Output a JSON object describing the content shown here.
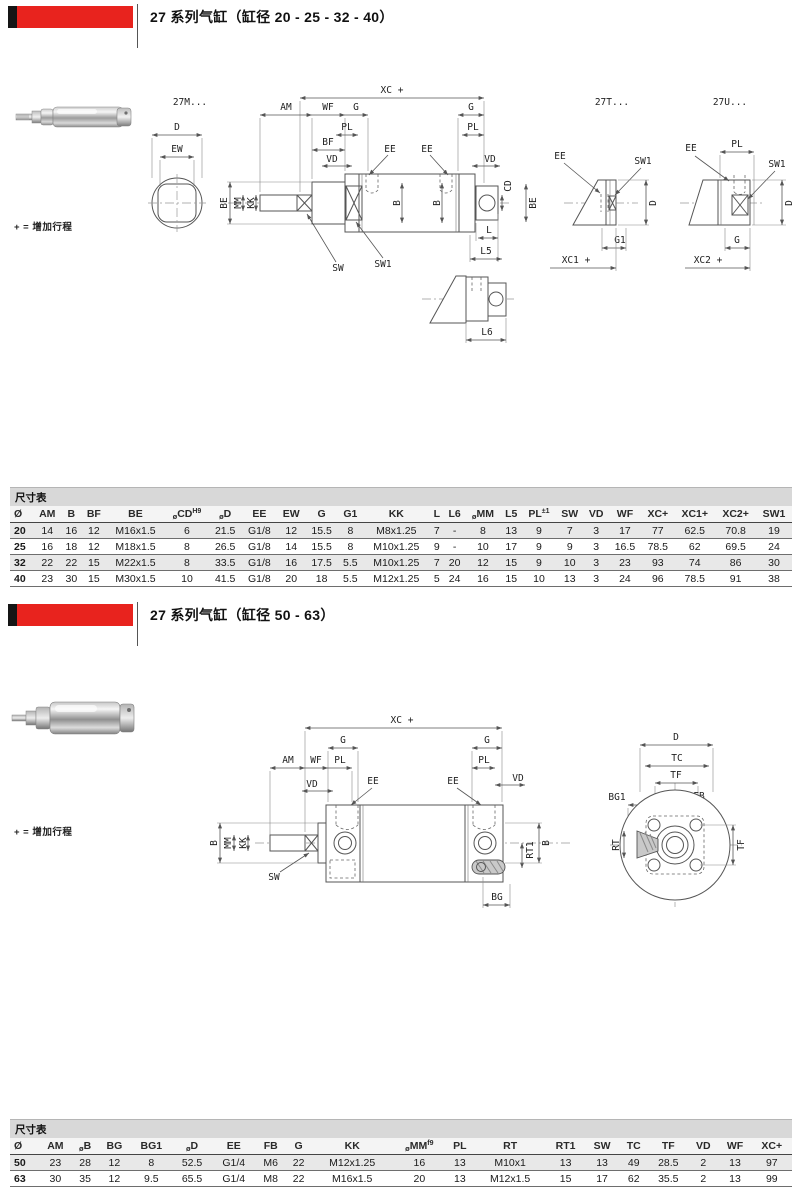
{
  "colors": {
    "accent": "#e8231e",
    "black_tab": "#151515",
    "row_shade": "#e8e8e8",
    "caption_bg": "#d8d8d8"
  },
  "section1": {
    "title": "27 系列气缸（缸径 20 - 25 - 32 - 40）",
    "stroke_note": "+ = 增加行程",
    "models": {
      "m": "27M...",
      "t": "27T...",
      "u": "27U..."
    },
    "table": {
      "caption": "尺寸表",
      "columns": [
        {
          "label": "Ø"
        },
        {
          "label": "AM"
        },
        {
          "label": "B"
        },
        {
          "label": "BF"
        },
        {
          "label": "BE"
        },
        {
          "pre": "ø",
          "label": "CD",
          "sup": "H9"
        },
        {
          "pre": "ø",
          "label": "D"
        },
        {
          "label": "EE"
        },
        {
          "label": "EW"
        },
        {
          "label": "G"
        },
        {
          "label": "G1"
        },
        {
          "label": "KK"
        },
        {
          "label": "L"
        },
        {
          "label": "L6"
        },
        {
          "pre": "ø",
          "label": "MM"
        },
        {
          "label": "L5"
        },
        {
          "label": "PL",
          "sup": "±1"
        },
        {
          "label": "SW"
        },
        {
          "label": "VD"
        },
        {
          "label": "WF"
        },
        {
          "label": "XC+"
        },
        {
          "label": "XC1+"
        },
        {
          "label": "XC2+"
        },
        {
          "label": "SW1"
        }
      ],
      "rows": [
        {
          "size": "20",
          "values": [
            "14",
            "16",
            "12",
            "M16x1.5",
            "6",
            "21.5",
            "G1/8",
            "12",
            "15.5",
            "8",
            "M8x1.25",
            "7",
            "-",
            "8",
            "13",
            "9",
            "7",
            "3",
            "17",
            "77",
            "62.5",
            "70.8",
            "19"
          ]
        },
        {
          "size": "25",
          "values": [
            "16",
            "18",
            "12",
            "M18x1.5",
            "8",
            "26.5",
            "G1/8",
            "14",
            "15.5",
            "8",
            "M10x1.25",
            "9",
            "-",
            "10",
            "17",
            "9",
            "9",
            "3",
            "16.5",
            "78.5",
            "62",
            "69.5",
            "24"
          ]
        },
        {
          "size": "32",
          "values": [
            "22",
            "22",
            "15",
            "M22x1.5",
            "8",
            "33.5",
            "G1/8",
            "16",
            "17.5",
            "5.5",
            "M10x1.25",
            "7",
            "20",
            "12",
            "15",
            "9",
            "10",
            "3",
            "23",
            "93",
            "74",
            "86",
            "30"
          ]
        },
        {
          "size": "40",
          "values": [
            "23",
            "30",
            "15",
            "M30x1.5",
            "10",
            "41.5",
            "G1/8",
            "20",
            "18",
            "5.5",
            "M12x1.25",
            "5",
            "24",
            "16",
            "15",
            "10",
            "13",
            "3",
            "24",
            "96",
            "78.5",
            "91",
            "38"
          ]
        }
      ]
    }
  },
  "section2": {
    "title": "27 系列气缸（缸径 50 - 63）",
    "stroke_note": "+ = 增加行程",
    "table": {
      "caption": "尺寸表",
      "columns": [
        {
          "label": "Ø"
        },
        {
          "label": "AM"
        },
        {
          "pre": "ø",
          "label": "B"
        },
        {
          "label": "BG"
        },
        {
          "label": "BG1"
        },
        {
          "pre": "ø",
          "label": "D"
        },
        {
          "label": "EE"
        },
        {
          "label": "FB"
        },
        {
          "label": "G"
        },
        {
          "label": "KK"
        },
        {
          "pre": "ø",
          "label": "MM",
          "sup": "f9"
        },
        {
          "label": "PL"
        },
        {
          "label": "RT"
        },
        {
          "label": "RT1"
        },
        {
          "label": "SW"
        },
        {
          "label": "TC"
        },
        {
          "label": "TF"
        },
        {
          "label": "VD"
        },
        {
          "label": "WF"
        },
        {
          "label": "XC+"
        }
      ],
      "rows": [
        {
          "size": "50",
          "values": [
            "23",
            "28",
            "12",
            "8",
            "52.5",
            "G1/4",
            "M6",
            "22",
            "M12x1.25",
            "16",
            "13",
            "M10x1",
            "13",
            "13",
            "49",
            "28.5",
            "2",
            "13",
            "97"
          ]
        },
        {
          "size": "63",
          "values": [
            "30",
            "35",
            "12",
            "9.5",
            "65.5",
            "G1/4",
            "M8",
            "22",
            "M16x1.5",
            "20",
            "13",
            "M12x1.5",
            "15",
            "17",
            "62",
            "35.5",
            "2",
            "13",
            "99"
          ]
        }
      ]
    }
  },
  "dims": {
    "xc": "XC +",
    "xc1": "XC1 +",
    "xc2": "XC2 +",
    "am": "AM",
    "wf": "WF",
    "g": "G",
    "g1": "G1",
    "pl": "PL",
    "bf": "BF",
    "vd": "VD",
    "ee": "EE",
    "d": "D",
    "ew": "EW",
    "be": "BE",
    "mm": "MM",
    "kk": "KK",
    "b": "B",
    "cd": "CD",
    "l": "L",
    "l5": "L5",
    "l6": "L6",
    "sw": "SW",
    "sw1": "SW1",
    "rt1": "RT1",
    "bg": "BG",
    "tc": "TC",
    "tf": "TF",
    "bg1": "BG1",
    "fb": "FB",
    "rt": "RT"
  }
}
